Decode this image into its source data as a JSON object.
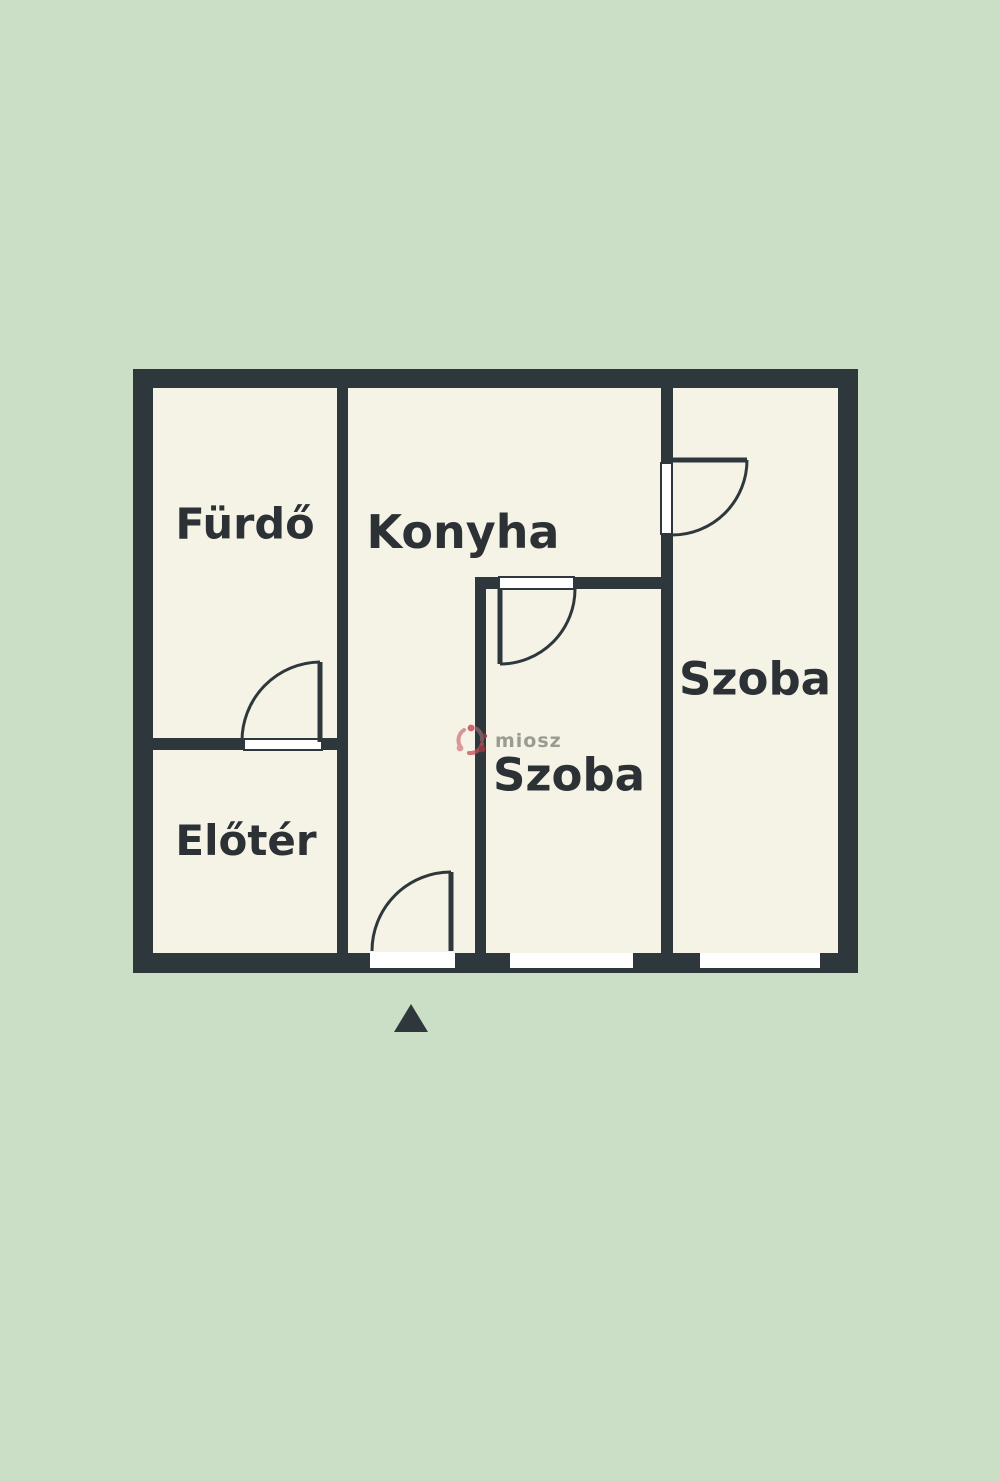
{
  "colors": {
    "background": "#cbdfc6",
    "floor": "#f5f3e5",
    "wall": "#2e383c",
    "label_ink": "#2b3135",
    "watermark_text_color": "#8b8d85",
    "watermark_logo_color": "#c4505e",
    "opening_white": "#ffffff"
  },
  "plan": {
    "type": "floor-plan",
    "rooms": [
      {
        "id": "furdo",
        "label": "Fürdő",
        "position": "top-left"
      },
      {
        "id": "konyha",
        "label": "Konyha",
        "position": "top-middle"
      },
      {
        "id": "eloter",
        "label": "Előtér",
        "position": "bottom-left"
      },
      {
        "id": "szoba_middle",
        "label": "Szoba",
        "position": "bottom-middle"
      },
      {
        "id": "szoba_right",
        "label": "Szoba",
        "position": "right"
      }
    ],
    "doors": [
      {
        "id": "furdo-door",
        "between": [
          "eloter",
          "furdo"
        ],
        "swing": "up-left"
      },
      {
        "id": "entrance-door",
        "between": [
          "outside",
          "konyha"
        ],
        "swing": "up-left"
      },
      {
        "id": "szoba-middle-door",
        "between": [
          "konyha",
          "szoba_middle"
        ],
        "swing": "down-right"
      },
      {
        "id": "szoba-right-door",
        "between": [
          "konyha",
          "szoba_right"
        ],
        "swing": "down-right"
      }
    ],
    "windows": [
      {
        "id": "window-szoba-middle",
        "wall": "bottom"
      },
      {
        "id": "window-szoba-right",
        "wall": "bottom"
      }
    ],
    "north_marker": "▲"
  },
  "watermark": {
    "text": "miosz"
  }
}
